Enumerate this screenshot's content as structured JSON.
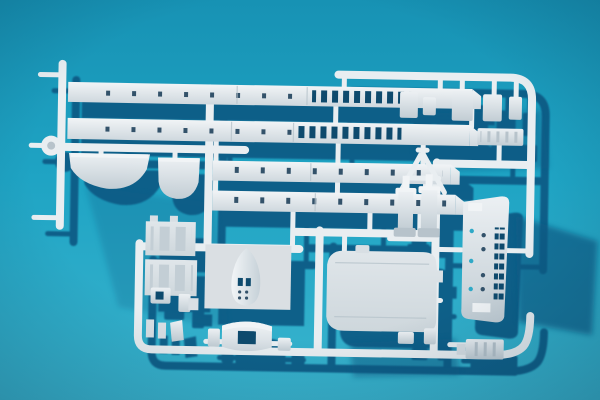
{
  "scene": {
    "title": "White plastic model-kit sprue photographed on a turquoise backdrop",
    "type": "photograph",
    "lighting": "hard sunlight from upper left casting deep navy shadows down and to the right"
  },
  "colors": {
    "bg-top": "#1792b4",
    "bg-mid": "#1fa4c4",
    "bg-bottom": "#3ab4ce",
    "shadow": "#0d5b86",
    "tube": "#e9eef1",
    "plastic": "#d8dfe4",
    "plastic-bright": "#f1f4f6",
    "plastic-shade": "#b7c3cb",
    "hole": "#0e4a6d",
    "mark": "#33526a",
    "panel-indent": "#c3ced5",
    "porthole": "#2fa9c7",
    "vignette": "rgba(3,40,66,0.28)"
  },
  "parts": [
    {
      "name": "sprue-frame",
      "label": "white runner frame with rounded corners"
    },
    {
      "name": "superstructure-strip-upper",
      "label": "long superstructure side strip with row of windows"
    },
    {
      "name": "superstructure-strip-lower",
      "label": "second long superstructure side strip with windows"
    },
    {
      "name": "deckhouse-strip-upper",
      "label": "medium deckhouse side strip with small windows"
    },
    {
      "name": "deckhouse-strip-lower",
      "label": "second medium deckhouse strip"
    },
    {
      "name": "lifeboat-large",
      "label": "large lifeboat hull half"
    },
    {
      "name": "lifeboat-small",
      "label": "small lifeboat hull half"
    },
    {
      "name": "deckhouse-blocks",
      "label": "cluster of small deckhouse blocks at top right"
    },
    {
      "name": "ribbed-vent-strip",
      "label": "small ribbed vent strip"
    },
    {
      "name": "a-frame-mast",
      "label": "A-frame mast"
    },
    {
      "name": "vent-cylinders",
      "label": "two cylindrical vent / winch parts"
    },
    {
      "name": "bulkhead-panels",
      "label": "two flat bulkhead panels with faint window indents"
    },
    {
      "name": "boat-on-plate",
      "label": "small boat hull moulded on a flat plate"
    },
    {
      "name": "bridge-band",
      "label": "curved bridge-front band with opening"
    },
    {
      "name": "main-deck",
      "label": "large rounded main deck piece"
    },
    {
      "name": "hull-side-section",
      "label": "hull side section with portholes and ladder strip"
    },
    {
      "name": "ribbed-hatch",
      "label": "small ribbed hatch near bottom rail"
    },
    {
      "name": "small-fittings",
      "label": "assorted small fittings bottom left"
    }
  ]
}
